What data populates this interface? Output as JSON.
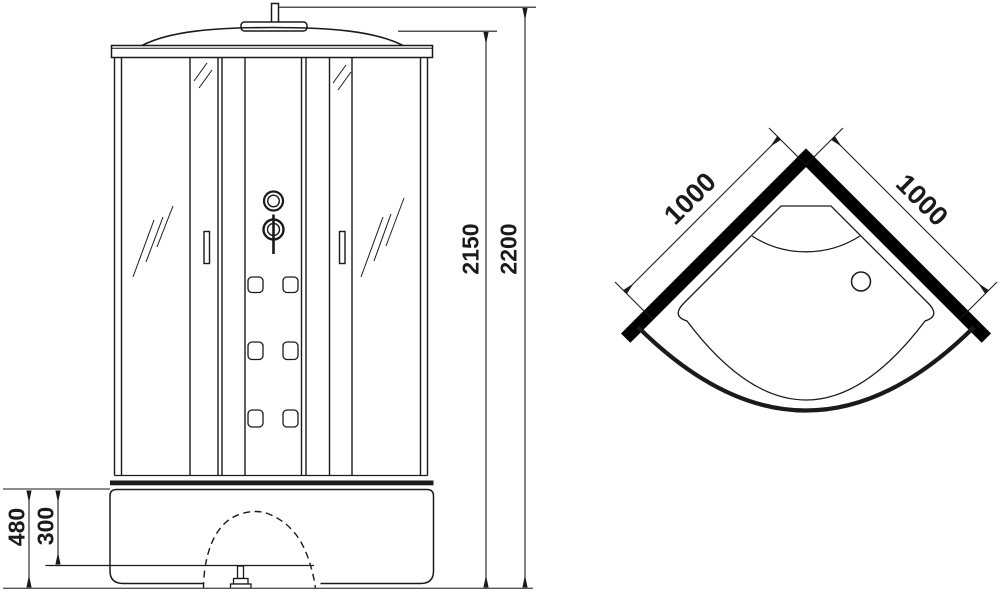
{
  "colors": {
    "ink": "#1a1a1a",
    "wall_fill": "#000000",
    "background": "#ffffff",
    "ground": "#555555"
  },
  "front_view": {
    "dims": {
      "overall_height": "2200",
      "cabin_height": "2150",
      "base_height": "480",
      "tray_inner_height": "300"
    }
  },
  "top_view": {
    "dims": {
      "left_side": "1000",
      "right_side": "1000"
    }
  }
}
